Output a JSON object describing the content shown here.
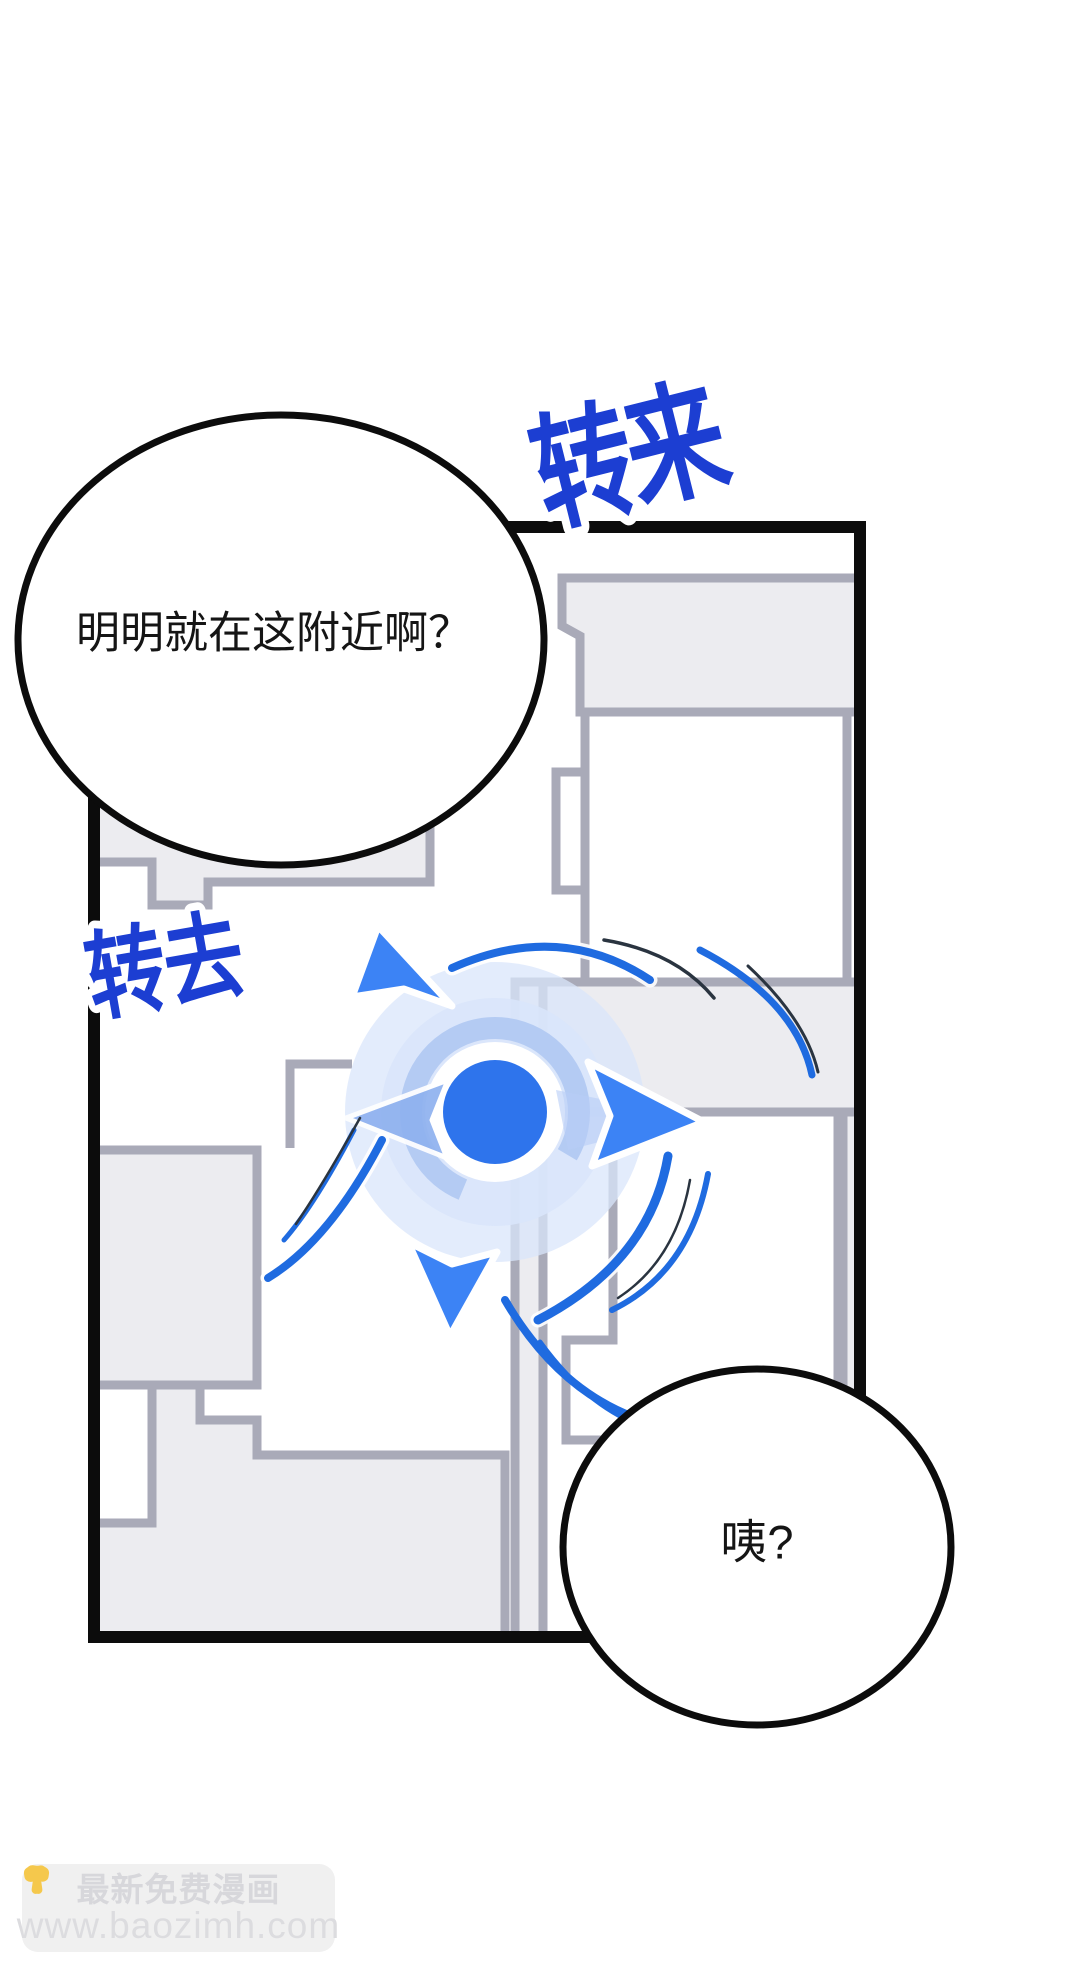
{
  "scene": {
    "type": "comic-panel-with-navigation-map"
  },
  "panel": {
    "border_color": "#0c0c0c",
    "road_fill": "#ececf0",
    "outline_color": "#a9aab8",
    "block_fill": "#ffffff"
  },
  "speech_bubbles": [
    {
      "text": "明明就在这附近啊？"
    },
    {
      "text": "咦?"
    }
  ],
  "sfx": [
    {
      "text": "转来",
      "color": "#1c3ed2"
    },
    {
      "text": "转去",
      "color": "#1c3ed2"
    }
  ],
  "compass": {
    "dot_color": "#2e74ec",
    "arrow_color": "#3c83f5",
    "side_arrow_color": "#8fb1ef",
    "ghost_arrow_color": "#b7cdf6",
    "glow_color": "#d9e6fb",
    "ring_color": "#b4cbf3",
    "swoosh_color": "#1f6be0",
    "swoosh_dark_color": "#2a3440"
  },
  "watermark": {
    "label": "最新免费漫画",
    "url": "www.baozimh.com",
    "left_icon": "pointing-down-hand",
    "right_icon": "pointing-down-hand",
    "box_color": "#f0f0f0",
    "text_color": "#d7d7db",
    "url_color": "#dcdcdf",
    "hand_color": "#f5c84c"
  }
}
